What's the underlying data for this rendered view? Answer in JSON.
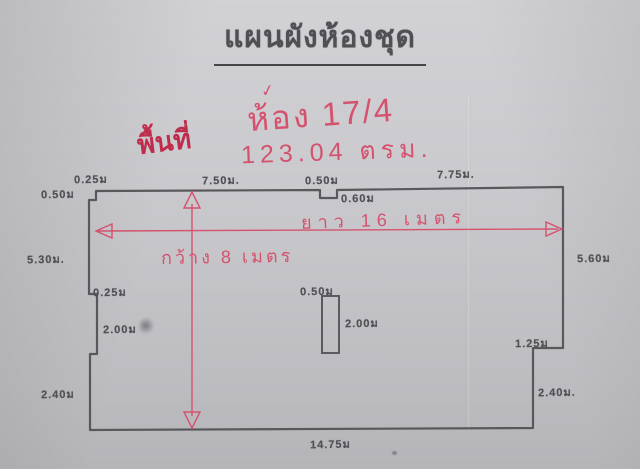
{
  "document": {
    "title": "แผนผังห้องชุด"
  },
  "handwriting": {
    "checkmark": "✓",
    "room": "ห้อง 17/4",
    "area_label": "พื้นที่",
    "area_value": "123.04 ตรม.",
    "length_arrow_label": "ยาว 16 เมตร",
    "width_arrow_label": "กว้าง 8 เมตร"
  },
  "plan": {
    "dims": [
      "0.50ม",
      "0.25ม",
      "7.50ม.",
      "0.50ม",
      "0.60ม",
      "7.75ม.",
      "5.30ม.",
      "5.60ม",
      "0.25ม",
      "2.00ม",
      "2.40ม",
      "1.25ม",
      "2.40ม.",
      "14.75ม",
      "0.50ม",
      "2.00ม"
    ]
  },
  "colors": {
    "paper": "#c9c9cd",
    "pencil": "#4f4f54",
    "red_ink": "#d5526e",
    "red_ink_dark": "#bf2c4c"
  }
}
